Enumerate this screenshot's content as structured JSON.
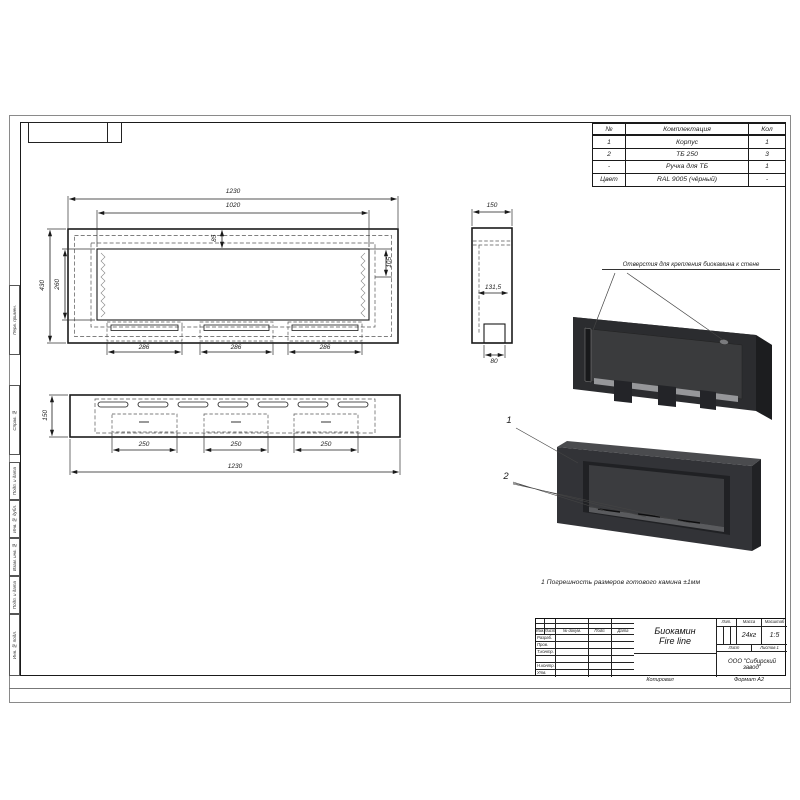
{
  "bom": {
    "headers": [
      "№",
      "Комплектация",
      "Кол"
    ],
    "rows": [
      [
        "1",
        "Корпус",
        "1"
      ],
      [
        "2",
        "ТБ 250",
        "3"
      ],
      [
        "-",
        "Ручка для ТБ",
        "1"
      ],
      [
        "Цвет",
        "RAL 9005 (чёрный)",
        "-"
      ]
    ]
  },
  "dims": {
    "front_w": "1230",
    "front_wi": "1020",
    "front_h": "430",
    "front_hi": "260",
    "front_t": "85",
    "front_r": "105",
    "front_s1": "286",
    "front_s2": "286",
    "front_s3": "286",
    "side_w": "150",
    "side_i": "131,5",
    "side_b": "80",
    "top_h": "150",
    "top_s1": "250",
    "top_s2": "250",
    "top_s3": "250",
    "top_w": "1230"
  },
  "annotation": "Отверстия для крепления биокамина к стене",
  "callout_1": "1",
  "callout_2": "2",
  "note": "1 Погрешность размеров готового камина ±1мм",
  "tb": {
    "title1": "Биокамин",
    "title2": "Fire line",
    "col_izm": "Изм.",
    "col_list": "Лист",
    "col_doc": "№ докум.",
    "col_podp": "Подп.",
    "col_data": "Дата",
    "row_razrab": "Разраб.",
    "row_prov": "Пров.",
    "row_tkontr": "Т.контр.",
    "row_nkontr": "Н.контр.",
    "row_utv": "Утв.",
    "h_lit": "Лит.",
    "h_massa": "Масса",
    "h_masshtab": "Масштаб",
    "v_massa": "24кг",
    "v_masshtab": "1:5",
    "h_list": "Лист",
    "h_listov": "Листов 1",
    "company1": "ООО \"Сибирский",
    "company2": "завод\"",
    "kopiroval": "Копировал",
    "format": "Формат  А2"
  },
  "margin": [
    "Перв. примен.",
    "Справ. №",
    "Подп. и дата",
    "Инв. № дубл.",
    "Взам. инв. №",
    "Подп. и дата",
    "Инв. № подл."
  ]
}
